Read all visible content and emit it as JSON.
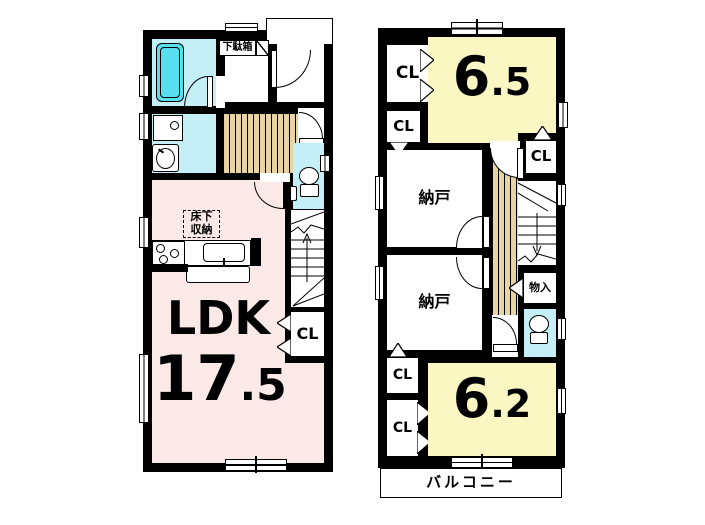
{
  "colors": {
    "wall": "#000000",
    "pink": "#fbe9e8",
    "yellow": "#faf7c2",
    "cyan": "#c5eff7",
    "tub": "#58e0f1",
    "tan": "#e8d4a3"
  },
  "floor1": {
    "shoe_cabinet": "下駄箱",
    "underfloor_storage_line1": "床下",
    "underfloor_storage_line2": "収納",
    "ldk_label": "LDK",
    "ldk_size_int": "17",
    "ldk_size_dec": ".5",
    "closet": "CL"
  },
  "floor2": {
    "room_top_int": "6",
    "room_top_dec": ".5",
    "room_bottom_int": "6",
    "room_bottom_dec": ".2",
    "closet1": "CL",
    "closet2": "CL",
    "closet_upper_right": "CL",
    "closet3": "CL",
    "closet4": "CL",
    "storage_room_1": "納戸",
    "storage_room_2": "納戸",
    "small_storage": "物入",
    "balcony": "バルコニー"
  }
}
